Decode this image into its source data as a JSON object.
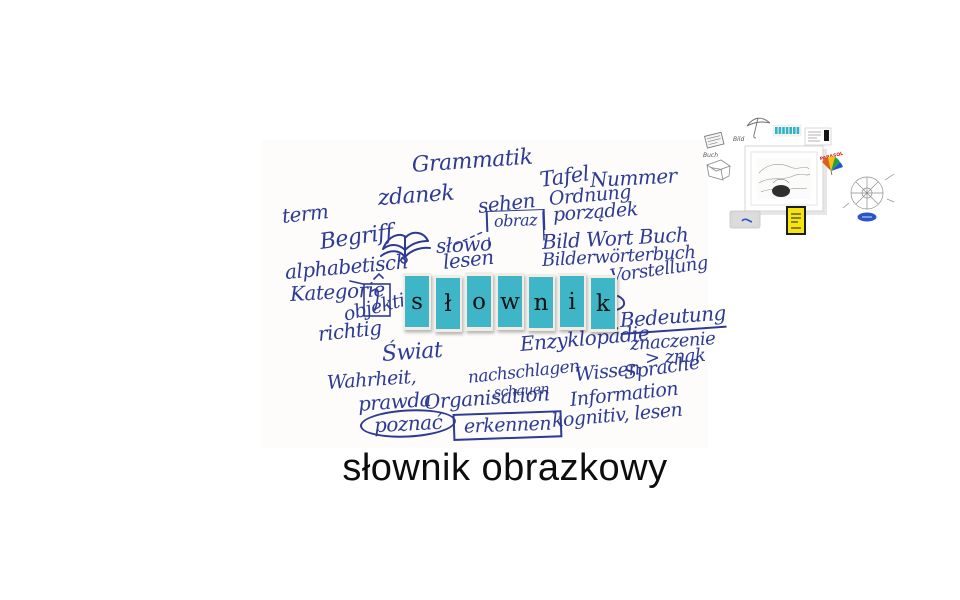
{
  "page": {
    "background": "#ffffff"
  },
  "mindmap": {
    "ink_color": "#2e3b94",
    "words": [
      {
        "text": "Grammatik",
        "x": 412,
        "y": 155,
        "size": 22,
        "rot": -4
      },
      {
        "text": "zdanek",
        "x": 378,
        "y": 188,
        "size": 22,
        "rot": -4
      },
      {
        "text": "term",
        "x": 282,
        "y": 206,
        "size": 20,
        "rot": -6
      },
      {
        "text": "sehen",
        "x": 478,
        "y": 196,
        "size": 20,
        "rot": -6
      },
      {
        "text": "obraz",
        "x": 486,
        "y": 211,
        "size": 16,
        "rot": -2,
        "deco": "halfbox"
      },
      {
        "text": "Tafel",
        "x": 540,
        "y": 170,
        "size": 21,
        "rot": -8
      },
      {
        "text": "Nummer",
        "x": 590,
        "y": 170,
        "size": 20,
        "rot": -3
      },
      {
        "text": "Ordnung",
        "x": 549,
        "y": 190,
        "size": 19,
        "rot": -5
      },
      {
        "text": "porządek",
        "x": 553,
        "y": 206,
        "size": 19,
        "rot": -4
      },
      {
        "text": "Begriff",
        "x": 320,
        "y": 232,
        "size": 22,
        "rot": -8
      },
      {
        "text": "słowo",
        "x": 436,
        "y": 236,
        "size": 20,
        "rot": -3
      },
      {
        "text": "lesen",
        "x": 443,
        "y": 252,
        "size": 20,
        "rot": -6
      },
      {
        "text": "Bild Wort Buch",
        "x": 542,
        "y": 232,
        "size": 20,
        "rot": -3
      },
      {
        "text": "Bilderwörterbuch",
        "x": 542,
        "y": 252,
        "size": 18,
        "rot": -3
      },
      {
        "text": "Vorstellung",
        "x": 610,
        "y": 268,
        "size": 18,
        "rot": -8
      },
      {
        "text": "alphabetisch",
        "x": 285,
        "y": 262,
        "size": 20,
        "rot": -5
      },
      {
        "text": "Kategorie",
        "x": 290,
        "y": 284,
        "size": 20,
        "rot": -3
      },
      {
        "text": "objektiv",
        "x": 344,
        "y": 306,
        "size": 19,
        "rot": -14
      },
      {
        "text": "richtig",
        "x": 318,
        "y": 324,
        "size": 20,
        "rot": -6
      },
      {
        "text": "Bedeutung",
        "x": 620,
        "y": 310,
        "size": 20,
        "rot": -4,
        "deco": "underline"
      },
      {
        "text": "Świat",
        "x": 382,
        "y": 344,
        "size": 22,
        "rot": -4
      },
      {
        "text": "Enzyklopädie",
        "x": 520,
        "y": 334,
        "size": 20,
        "rot": -5
      },
      {
        "text": "znaczenie",
        "x": 630,
        "y": 336,
        "size": 18,
        "rot": -4
      },
      {
        "text": "> znak",
        "x": 645,
        "y": 350,
        "size": 18,
        "rot": -3
      },
      {
        "text": "Wahrheit,",
        "x": 327,
        "y": 374,
        "size": 19,
        "rot": -4
      },
      {
        "text": "nachschlagen",
        "x": 468,
        "y": 370,
        "size": 17,
        "rot": -6
      },
      {
        "text": "schauen",
        "x": 494,
        "y": 386,
        "size": 14,
        "rot": -4
      },
      {
        "text": "Wissen",
        "x": 575,
        "y": 366,
        "size": 19,
        "rot": -6
      },
      {
        "text": "Sprache",
        "x": 624,
        "y": 364,
        "size": 19,
        "rot": -8
      },
      {
        "text": "prawda",
        "x": 358,
        "y": 394,
        "size": 20,
        "rot": -4
      },
      {
        "text": "Organisation",
        "x": 424,
        "y": 392,
        "size": 20,
        "rot": -4
      },
      {
        "text": "Information",
        "x": 570,
        "y": 391,
        "size": 19,
        "rot": -6
      },
      {
        "text": "poznać",
        "x": 360,
        "y": 412,
        "size": 20,
        "rot": -3,
        "deco": "oval"
      },
      {
        "text": "erkennen",
        "x": 453,
        "y": 414,
        "size": 19,
        "rot": -2,
        "deco": "box"
      },
      {
        "text": "kognitiv, lesen",
        "x": 552,
        "y": 412,
        "size": 19,
        "rot": -5
      }
    ],
    "sketches": [
      "open-book-sketch",
      "kategorie-box-sketch",
      "obraz-connector",
      "curl-arrow"
    ]
  },
  "tiles": {
    "letters": [
      "s",
      "ł",
      "o",
      "w",
      "n",
      "i",
      "k"
    ],
    "tile_color": "#3fb5c8",
    "card_color": "#f1ede2",
    "letter_color": "#141414"
  },
  "caption": {
    "text": "słownik obrazkowy",
    "color": "#0d0d0d"
  },
  "collage": {
    "labels": {
      "bild": "Bild",
      "buch": "Buch",
      "parasol": "PARASOL"
    },
    "items": [
      "book-sketch",
      "cube-sketch",
      "umbrella-sketch",
      "tile-strip",
      "ticket-card",
      "framed-picture",
      "parasol-sticker",
      "wheel-diagram-sketch",
      "blue-oval-sticker",
      "grey-pouch",
      "yellow-card"
    ]
  }
}
